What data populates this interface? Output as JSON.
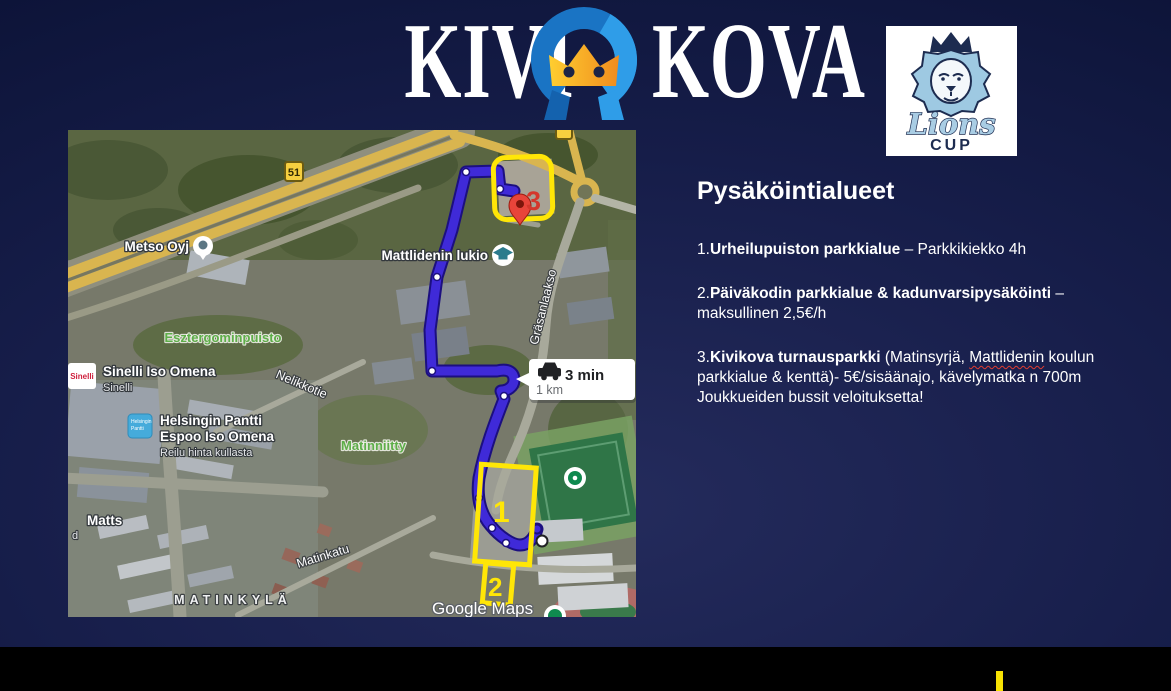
{
  "slide": {
    "logo": {
      "word_left": "KIVI",
      "word_right": "KOVA",
      "emblem_colors": {
        "ring_blue": "#1a74c4",
        "ring_light": "#2f9de8",
        "crown_yellow": "#ffce30",
        "crown_orange": "#f08c1e"
      }
    },
    "lions": {
      "script": "Lions",
      "cup": "CUP"
    },
    "parking": {
      "title": "Pysäköintialueet",
      "item1": {
        "num": "1.",
        "bold": "Urheilupuiston parkkialue",
        "rest": " – Parkkikiekko 4h"
      },
      "item2": {
        "num": "2.",
        "bold": "Päiväkodin parkkialue & kadunvarsipysäköinti",
        "rest": " –",
        "line2": "maksullinen 2,5€/h"
      },
      "item3": {
        "num": "3.",
        "bold": "Kivikova turnausparkki",
        "rest1": " (Matinsyrjä, ",
        "word": "Mattlidenin",
        "rest2": " koulun",
        "line2": "parkkialue & kenttä)- 5€/sisäänajo, kävelymatka n 700m",
        "line3": "Joukkueiden bussit veloituksetta!"
      }
    },
    "map": {
      "badge_51": "51",
      "pin3_label": "3",
      "area1_label": "1",
      "area2_label": "2",
      "route_time": "3 min",
      "route_dist": "1 km",
      "poi": {
        "metso": "Metso Oyj",
        "lukio": "Mattlidenin lukio",
        "esztergom": "Esztergominpuisto",
        "sinelli_badge": "Sinelli",
        "sinelli": "Sinelli Iso Omena",
        "sinelli_sub": "Sinelli",
        "pantti1": "Helsingin Pantti",
        "pantti2": "Espoo Iso Omena",
        "pantti_sub": "Reilu hinta kullasta",
        "pantti_icon1": "Helsingin",
        "pantti_icon2": "Pantti",
        "matinniitty": "Matinniitty",
        "matts": "Matts",
        "matts_fragment": "d",
        "district": "MATINKYLÄ",
        "watermark": "Google Maps"
      },
      "streets": {
        "nelikkotie": "Nelikkotie",
        "grasanlaakso": "Gräsanlaakso",
        "matinkatu": "Matinkatu"
      },
      "colors": {
        "route_blue": "#3f2ad8",
        "annotation_yellow": "#ffe607",
        "pin_red": "#e8443a"
      }
    },
    "colors": {
      "background_navy": "#161d49",
      "bottom_band": "#000000",
      "accent_yellow": "#f7e203"
    }
  }
}
